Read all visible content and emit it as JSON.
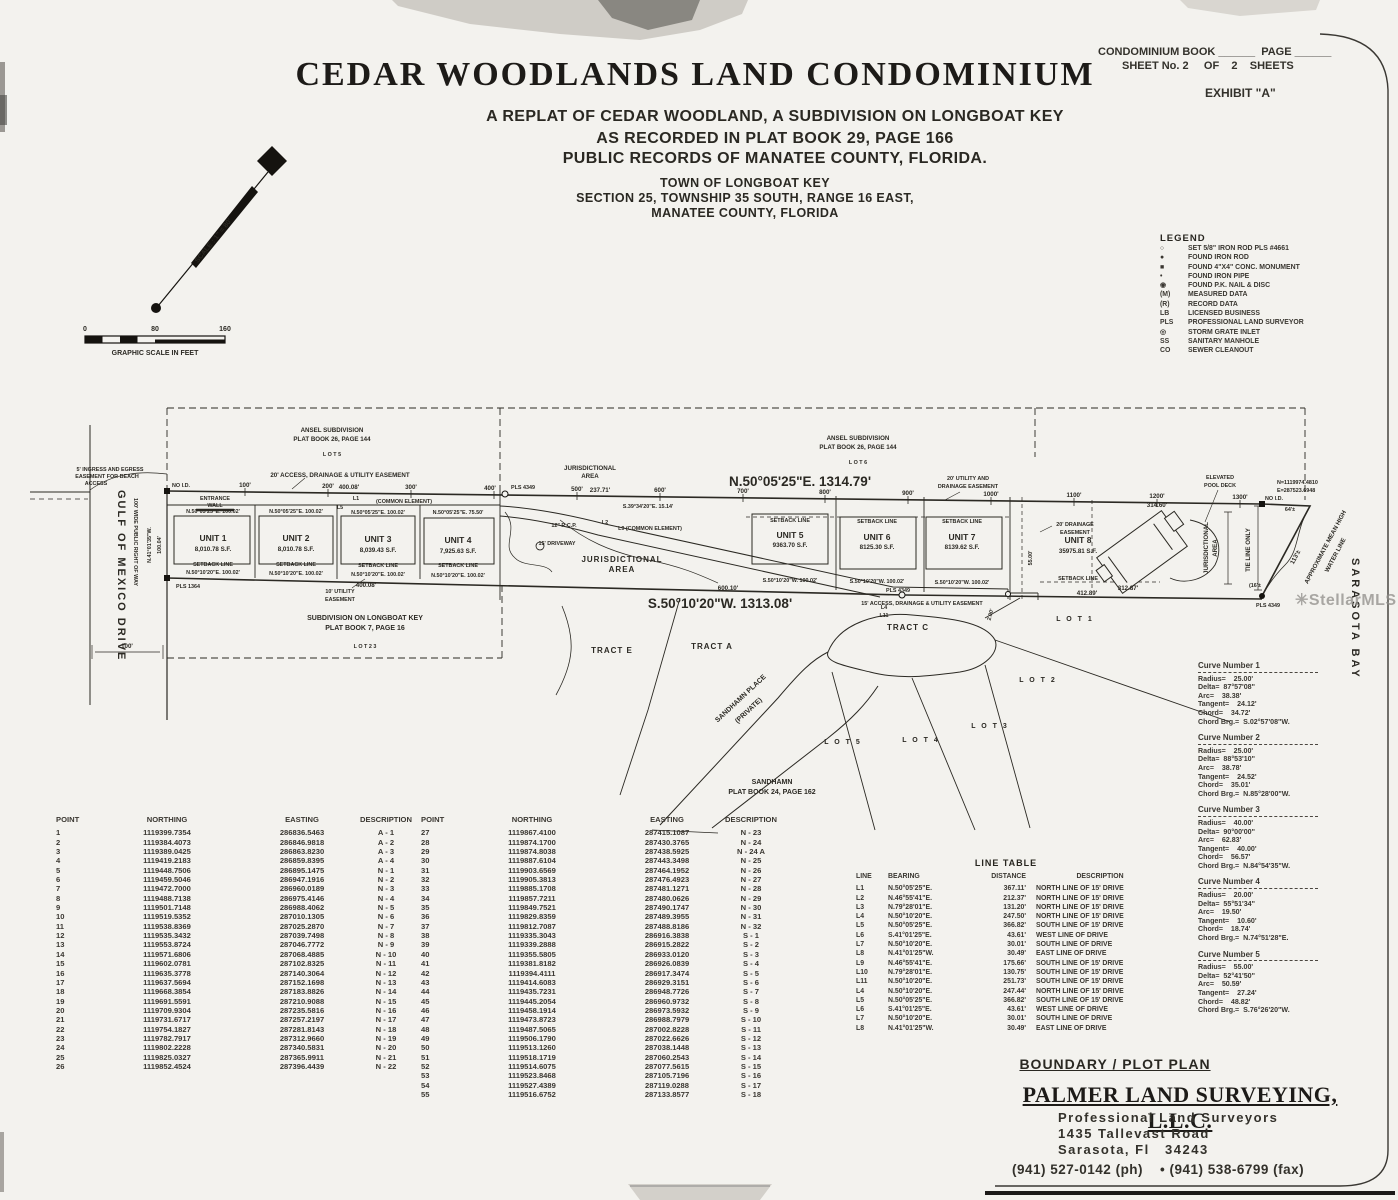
{
  "header": {
    "book_line": "CONDOMINIUM BOOK ______  PAGE ______",
    "sheet_line": "SHEET No. 2     OF    2    SHEETS",
    "exhibit": "EXHIBIT \"A\""
  },
  "title": {
    "main": "CEDAR WOODLANDS LAND CONDOMINIUM",
    "sub1": "A REPLAT OF CEDAR WOODLAND, A SUBDIVISION ON LONGBOAT KEY",
    "sub2": "AS RECORDED IN PLAT BOOK 29, PAGE 166",
    "sub3": "PUBLIC RECORDS OF MANATEE COUNTY, FLORIDA.",
    "town1": "TOWN OF LONGBOAT KEY",
    "town2": "SECTION 25, TOWNSHIP 35 SOUTH, RANGE 16 EAST,",
    "town3": "MANATEE COUNTY, FLORIDA"
  },
  "scale": {
    "label": "SCALE : 1\" = 80'",
    "ticks": [
      "0",
      "80",
      "160"
    ],
    "caption": "GRAPHIC SCALE IN FEET"
  },
  "legend": {
    "title": "LEGEND",
    "items": [
      [
        "○",
        "SET 5/8\" IRON ROD PLS #4661"
      ],
      [
        "●",
        "FOUND IRON ROD"
      ],
      [
        "■",
        "FOUND 4\"X4\" CONC. MONUMENT"
      ],
      [
        "•",
        "FOUND IRON PIPE"
      ],
      [
        "◉",
        "FOUND P.K. NAIL & DISC"
      ],
      [
        "(M)",
        "MEASURED DATA"
      ],
      [
        "(R)",
        "RECORD DATA"
      ],
      [
        "LB",
        "LICENSED BUSINESS"
      ],
      [
        "PLS",
        "PROFESSIONAL LAND SURVEYOR"
      ],
      [
        "◎",
        "STORM GRATE INLET"
      ],
      [
        "SS",
        "SANITARY MANHOLE"
      ],
      [
        "CO",
        "SEWER CLEANOUT"
      ]
    ]
  },
  "plat": {
    "ticks": [
      "100'",
      "200'",
      "300'",
      "400'",
      "500'",
      "600'",
      "700'",
      "800'",
      "900'",
      "1000'",
      "1100'",
      "1200'",
      "1300'"
    ],
    "units": [
      {
        "name": "UNIT 1",
        "area": "8,010.78 S.F.",
        "top": "N.50°05'25\"E.  100.02'",
        "bottom": "N.50°10'20\"E.  100.02'"
      },
      {
        "name": "UNIT 2",
        "area": "8,010.78 S.F.",
        "top": "N.50°05'25\"E.  100.02'",
        "bottom": "N.50°10'20\"E.  100.02'"
      },
      {
        "name": "UNIT 3",
        "area": "8,039.43 S.F.",
        "top": "N.50°05'25\"E.  100.02'",
        "bottom": "N.50°10'20\"E.  100.02'"
      },
      {
        "name": "UNIT 4",
        "area": "7,925.63 S.F.",
        "top": "N.50°05'25\"E.  75.50'",
        "bottom": "N.50°10'20\"E.  100.02'"
      },
      {
        "name": "UNIT 5",
        "area": "9363.70 S.F.",
        "bottom": "S.50°10'20\"W.  100.02'"
      },
      {
        "name": "UNIT 6",
        "area": "8125.30 S.F.",
        "bottom": "S.50°10'20\"W.  100.02'"
      },
      {
        "name": "UNIT 7",
        "area": "8139.62 S.F.",
        "bottom": "S.50°10'20\"W.  100.02'"
      },
      {
        "name": "UNIT 8",
        "area": "35975.81 S.F."
      }
    ],
    "labels": {
      "ansel1": "ANSEL SUBDIVISION",
      "ansel2": "PLAT BOOK 26, PAGE 144",
      "lot5_sub": "L O T   5",
      "lot6_sub": "L O T   6",
      "jur1": "JURISDICTIONAL",
      "jur2": "AREA",
      "brgN": "N.50°05'25\"E.   1314.79'",
      "brgS": "S.50°10'20\"W.   1313.08'",
      "esmt20": "20' ACCESS, DRAINAGE & UTILITY EASEMENT",
      "esmt15": "15' ACCESS, DRAINAGE & UTILITY EASEMENT",
      "d400": "400.08'",
      "d237": "237.71'",
      "s39": "S.39°34'20\"E.  15.14'",
      "d600": "600.10'",
      "l1": "L1",
      "l2": "L2",
      "l5": "L5",
      "l4": "L4",
      "l11": "L11",
      "common": "(COMMON ELEMENT)",
      "l9c": "L9  (COMMON ELEMENT)",
      "rcp": "12\" R.C.P.",
      "drv": "15' DRIVEWAY",
      "setback": "SETBACK LINE",
      "tractE": "TRACT E",
      "tractA": "TRACT A",
      "tractC": "TRACT C",
      "lot1": "L O T  1",
      "lot2": "L O T  2",
      "lot3": "L O T  3",
      "lot4": "L O T  4",
      "lot5": "L O T  5",
      "shp1": "SANDHAMN PLACE",
      "shp2": "(PRIVATE)",
      "sh1": "SANDHAMN",
      "sh2": "PLAT BOOK 24, PAGE 162",
      "sub1": "SUBDIVISION ON LONGBOAT KEY",
      "sub2": "PLAT BOOK 7, PAGE 16",
      "lot23": "L O T   2 3",
      "ut1": "10' UTILITY",
      "ut2": "EASEMENT",
      "ue20a": "20' UTILITY AND",
      "ue20b": "DRAINAGE EASEMENT",
      "de20a": "20' DRAINAGE",
      "de20b": "EASEMENT",
      "d412": "412.89'",
      "d312": "312.87'",
      "d314": "314.60'",
      "ep1": "ELEVATED",
      "ep2": "POOL DECK",
      "coordN": "N=1119974.4810",
      "coordE": "E=287523.6948",
      "noid": "NO I.D.",
      "d64": "64'±",
      "d113": "113'±",
      "d16": "(16'±",
      "d55": "55.00'",
      "d2": "2.00'",
      "mhw1": "APPROXIMATE MEAN HIGH",
      "mhw2": "WATER LINE",
      "tie": "TIE LINE ONLY",
      "pls4349": "PLS 4349",
      "pls1364": "PLS 1364",
      "bay": "SARASOTA BAY",
      "gulf": "GULF OF MEXICO DRIVE",
      "row": "100' WIDE PUBLIC RIGHT OF WAY",
      "ing1": "5' INGRESS AND EGRESS",
      "ing2": "EASEMENT FOR BEACH",
      "ing3": "ACCESS",
      "ent1": "ENTRANCE",
      "ent2": "WALL",
      "d10004": "100.04'",
      "brg41": "N.41°01'35\"W.",
      "d100": "100'"
    }
  },
  "point_table": {
    "headers": [
      "POINT",
      "NORTHING",
      "EASTING",
      "DESCRIPTION"
    ],
    "rows_left": [
      [
        "1",
        "1119399.7354",
        "286836.5463",
        "A - 1"
      ],
      [
        "2",
        "1119384.4073",
        "286846.9818",
        "A - 2"
      ],
      [
        "3",
        "1119389.0425",
        "286863.8230",
        "A - 3"
      ],
      [
        "4",
        "1119419.2183",
        "286859.8395",
        "A - 4"
      ],
      [
        "5",
        "1119448.7506",
        "286895.1475",
        "N - 1"
      ],
      [
        "6",
        "1119459.5046",
        "286947.1916",
        "N - 2"
      ],
      [
        "7",
        "1119472.7000",
        "286960.0189",
        "N - 3"
      ],
      [
        "8",
        "1119488.7138",
        "286975.4146",
        "N - 4"
      ],
      [
        "9",
        "1119501.7148",
        "286988.4062",
        "N - 5"
      ],
      [
        "10",
        "1119519.5352",
        "287010.1305",
        "N - 6"
      ],
      [
        "11",
        "1119538.8369",
        "287025.2870",
        "N - 7"
      ],
      [
        "12",
        "1119535.3432",
        "287039.7498",
        "N - 8"
      ],
      [
        "13",
        "1119553.8724",
        "287046.7772",
        "N - 9"
      ],
      [
        "14",
        "1119571.6806",
        "287068.4885",
        "N - 10"
      ],
      [
        "15",
        "1119602.0781",
        "287102.8325",
        "N - 11"
      ],
      [
        "16",
        "1119635.3778",
        "287140.3064",
        "N - 12"
      ],
      [
        "17",
        "1119637.5694",
        "287152.1698",
        "N - 13"
      ],
      [
        "18",
        "1119668.3854",
        "287183.8826",
        "N - 14"
      ],
      [
        "19",
        "1119691.5591",
        "287210.9088",
        "N - 15"
      ],
      [
        "20",
        "1119709.9304",
        "287235.5816",
        "N - 16"
      ],
      [
        "21",
        "1119731.6717",
        "287257.2197",
        "N - 17"
      ],
      [
        "22",
        "1119754.1827",
        "287281.8143",
        "N - 18"
      ],
      [
        "23",
        "1119782.7917",
        "287312.9660",
        "N - 19"
      ],
      [
        "24",
        "1119802.2228",
        "287340.5831",
        "N - 20"
      ],
      [
        "25",
        "1119825.0327",
        "287365.9911",
        "N - 21"
      ],
      [
        "26",
        "1119852.4524",
        "287396.4439",
        "N - 22"
      ]
    ],
    "rows_right": [
      [
        "27",
        "1119867.4100",
        "287415.1087",
        "N - 23"
      ],
      [
        "28",
        "1119874.1700",
        "287430.3765",
        "N - 24"
      ],
      [
        "29",
        "1119874.8038",
        "287438.5925",
        "N - 24 A"
      ],
      [
        "30",
        "1119887.6104",
        "287443.3498",
        "N - 25"
      ],
      [
        "31",
        "1119903.6569",
        "287464.1952",
        "N - 26"
      ],
      [
        "32",
        "1119905.3813",
        "287476.4923",
        "N - 27"
      ],
      [
        "33",
        "1119885.1708",
        "287481.1271",
        "N - 28"
      ],
      [
        "34",
        "1119857.7211",
        "287480.0626",
        "N - 29"
      ],
      [
        "35",
        "1119849.7521",
        "287490.1747",
        "N - 30"
      ],
      [
        "36",
        "1119829.8359",
        "287489.3955",
        "N - 31"
      ],
      [
        "37",
        "1119812.7087",
        "287488.8186",
        "N - 32"
      ],
      [
        "38",
        "1119335.3043",
        "286916.3838",
        "S - 1"
      ],
      [
        "39",
        "1119339.2888",
        "286915.2822",
        "S - 2"
      ],
      [
        "40",
        "1119355.5805",
        "286933.0120",
        "S - 3"
      ],
      [
        "41",
        "1119381.8182",
        "286926.0839",
        "S - 4"
      ],
      [
        "42",
        "1119394.4111",
        "286917.3474",
        "S - 5"
      ],
      [
        "43",
        "1119414.6083",
        "286929.3151",
        "S - 6"
      ],
      [
        "44",
        "1119435.7231",
        "286948.7726",
        "S - 7"
      ],
      [
        "45",
        "1119445.2054",
        "286960.9732",
        "S - 8"
      ],
      [
        "46",
        "1119458.1914",
        "286973.5932",
        "S - 9"
      ],
      [
        "47",
        "1119473.8723",
        "286988.7979",
        "S - 10"
      ],
      [
        "48",
        "1119487.5065",
        "287002.8228",
        "S - 11"
      ],
      [
        "49",
        "1119506.1790",
        "287022.6626",
        "S - 12"
      ],
      [
        "50",
        "1119513.1260",
        "287038.1448",
        "S - 13"
      ],
      [
        "51",
        "1119518.1719",
        "287060.2543",
        "S - 14"
      ],
      [
        "52",
        "1119514.6075",
        "287077.5615",
        "S - 15"
      ],
      [
        "53",
        "1119523.8468",
        "287105.7196",
        "S - 16"
      ],
      [
        "54",
        "1119527.4389",
        "287119.0288",
        "S - 17"
      ],
      [
        "55",
        "1119516.6752",
        "287133.8577",
        "S - 18"
      ]
    ]
  },
  "line_table": {
    "title": "LINE TABLE",
    "headers": [
      "LINE",
      "BEARING",
      "DISTANCE",
      "DESCRIPTION"
    ],
    "rows": [
      [
        "L1",
        "N.50°05'25\"E.",
        "367.11'",
        "NORTH LINE OF 15' DRIVE"
      ],
      [
        "L2",
        "N.46°55'41\"E.",
        "212.37'",
        "NORTH LINE OF 15' DRIVE"
      ],
      [
        "L3",
        "N.79°28'01\"E.",
        "131.20'",
        "NORTH LINE OF 15' DRIVE"
      ],
      [
        "L4",
        "N.50°10'20\"E.",
        "247.50'",
        "NORTH LINE OF 15' DRIVE"
      ],
      [
        "L5",
        "N.50°05'25\"E.",
        "366.82'",
        "SOUTH LINE OF 15' DRIVE"
      ],
      [
        "L6",
        "S.41°01'25\"E.",
        "43.61'",
        "WEST LINE OF DRIVE"
      ],
      [
        "L7",
        "N.50°10'20\"E.",
        "30.01'",
        "SOUTH LINE OF DRIVE"
      ],
      [
        "L8",
        "N.41°01'25\"W.",
        "30.49'",
        "EAST LINE OF DRIVE"
      ],
      [
        "L9",
        "N.46°55'41\"E.",
        "175.66'",
        "SOUTH LINE OF 15' DRIVE"
      ],
      [
        "L10",
        "N.79°28'01\"E.",
        "130.75'",
        "SOUTH LINE OF 15' DRIVE"
      ],
      [
        "L11",
        "N.50°10'20\"E.",
        "251.73'",
        "SOUTH LINE OF 15' DRIVE"
      ],
      [
        "L4",
        "N.50°10'20\"E.",
        "247.44'",
        "NORTH LINE OF 15' DRIVE"
      ],
      [
        "L5",
        "N.50°05'25\"E.",
        "366.82'",
        "SOUTH LINE OF 15' DRIVE"
      ],
      [
        "L6",
        "S.41°01'25\"E.",
        "43.61'",
        "WEST LINE OF DRIVE"
      ],
      [
        "L7",
        "N.50°10'20\"E.",
        "30.01'",
        "SOUTH LINE OF DRIVE"
      ],
      [
        "L8",
        "N.41°01'25\"W.",
        "30.49'",
        "EAST LINE OF DRIVE"
      ]
    ]
  },
  "curve_tables": [
    {
      "title": "Curve Number 1",
      "rows": [
        "Radius=    25.00'",
        "Delta=  87°57'08\"",
        "Arc=    38.38'",
        "Tangent=    24.12'",
        "Chord=    34.72'",
        "Chord Brg.=  S.02°57'08\"W."
      ]
    },
    {
      "title": "Curve Number 2",
      "rows": [
        "Radius=    25.00'",
        "Delta=  88°53'10\"",
        "Arc=    38.78'",
        "Tangent=    24.52'",
        "Chord=    35.01'",
        "Chord Brg.=  N.85°28'00\"W."
      ]
    },
    {
      "title": "Curve Number 3",
      "rows": [
        "Radius=    40.00'",
        "Delta=  90°00'00\"",
        "Arc=    62.83'",
        "Tangent=    40.00'",
        "Chord=    56.57'",
        "Chord Brg.=  N.84°54'35\"W."
      ]
    },
    {
      "title": "Curve Number 4",
      "rows": [
        "Radius=    20.00'",
        "Delta=  55°51'34\"",
        "Arc=    19.50'",
        "Tangent=    10.60'",
        "Chord=    18.74'",
        "Chord Brg.=  N.74°51'28\"E."
      ]
    },
    {
      "title": "Curve Number 5",
      "rows": [
        "Radius=    55.00'",
        "Delta=  52°41'50\"",
        "Arc=    50.59'",
        "Tangent=    27.24'",
        "Chord=    48.82'",
        "Chord Brg.=  S.76°26'20\"W."
      ]
    }
  ],
  "footer": {
    "plan_type": "BOUNDARY / PLOT PLAN",
    "firm": "PALMER LAND SURVEYING, L.L.C.",
    "line1": "Professional Land Surveyors",
    "line2": "1435 Tallevast Road",
    "line3": "Sarasota, Fl   34243",
    "phone": "(941) 527-0142 (ph)    • (941) 538-6799 (fax)"
  },
  "watermark": "StellarMLS"
}
